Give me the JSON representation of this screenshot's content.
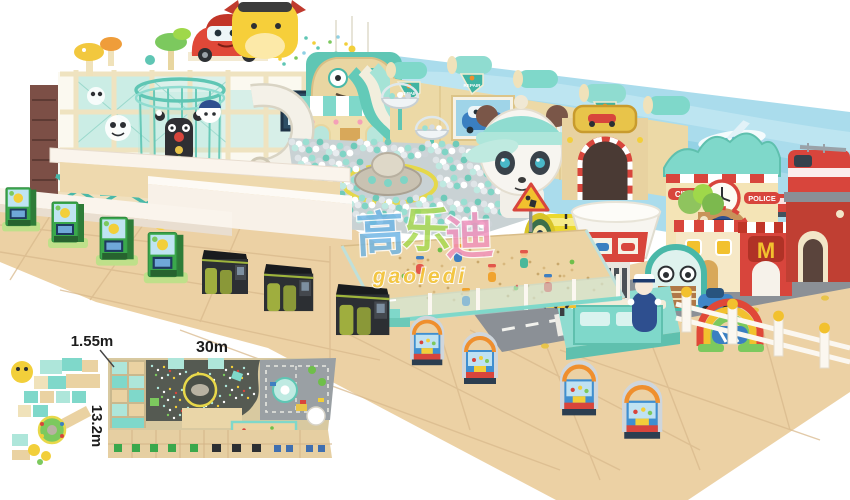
{
  "watermark": {
    "cn_chars": [
      "高",
      "乐",
      "迪"
    ],
    "en": "gaoledi"
  },
  "dimensions": {
    "platform_height": "1.55m",
    "width": "30m",
    "depth": "13.2m"
  },
  "signs": {
    "city": "CITY",
    "police": "POLICE",
    "repair": "REPAIR",
    "shop_m": "M"
  },
  "palette": {
    "teal": "#5fc6b4",
    "mint": "#aee6da",
    "cream": "#f0e2ba",
    "sand": "#ead2a2",
    "floor_tan": "#ecd1a4",
    "wall_blue": "#aadcec",
    "red": "#d8453c",
    "yellow": "#f2cf3a",
    "road_grey": "#8b9096",
    "machine_green": "#3aa84c",
    "machine_dark": "#2c2f33",
    "wall_white": "#faf4ec"
  }
}
